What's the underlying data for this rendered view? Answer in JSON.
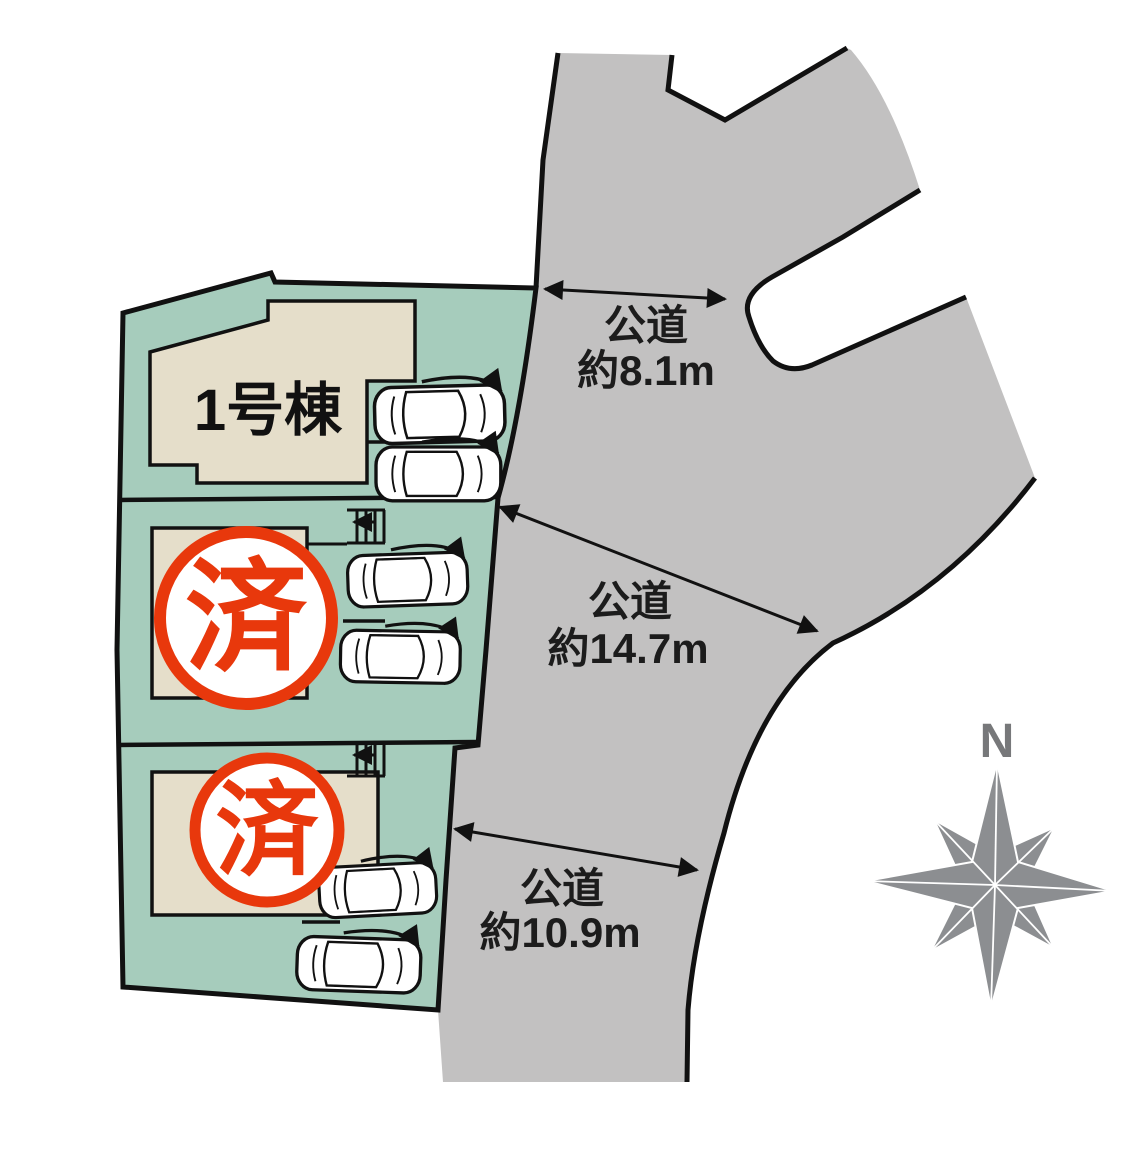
{
  "diagram": {
    "lots": [
      {
        "id": "lot-1",
        "label": "1号棟",
        "status": ""
      },
      {
        "id": "lot-2",
        "label": "",
        "status": "済"
      },
      {
        "id": "lot-3",
        "label": "",
        "status": "済"
      }
    ],
    "roads": [
      {
        "name": "公道",
        "width": "約8.1m"
      },
      {
        "name": "公道",
        "width": "約14.7m"
      },
      {
        "name": "公道",
        "width": "約10.9m"
      }
    ],
    "compass": {
      "north": "N"
    },
    "colors": {
      "lot_fill": "#a6ccbc",
      "building_fill": "#e5deca",
      "road_fill": "#c2c1c1",
      "sold_stamp_red": "#e8380c",
      "compass_gray": "#8c8e91",
      "outline_black": "#111111"
    }
  }
}
